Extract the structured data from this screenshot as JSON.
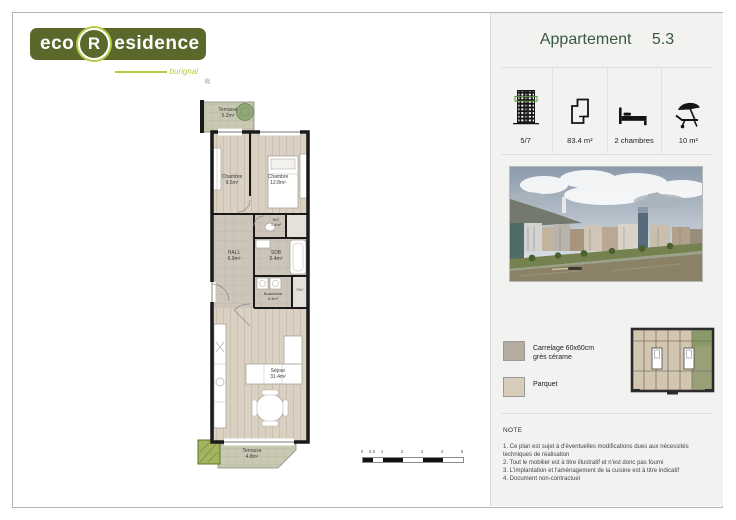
{
  "logo": {
    "eco": "eco",
    "r": "R",
    "esidence": "esidence",
    "subtitle": "burignal",
    "mark": "®",
    "colors": {
      "olive": "#5a682c",
      "light_green": "#b5cb47"
    }
  },
  "header": {
    "title": "Appartement",
    "number": "5.3",
    "color": "#3b5a41"
  },
  "stats": [
    {
      "icon": "building-icon",
      "label": "5/7"
    },
    {
      "icon": "floorplan-icon",
      "label": "83.4 m²"
    },
    {
      "icon": "bed-icon",
      "label": "2 chambres"
    },
    {
      "icon": "parasol-icon",
      "label": "10 m²"
    }
  ],
  "legend": {
    "items": [
      {
        "name": "carrelage",
        "line1": "Carrelage 60x60cm",
        "line2": "grès cérame",
        "color": "#b5ab9e"
      },
      {
        "name": "parquet",
        "line1": "Parquet",
        "line2": "",
        "color": "#d8cdbb"
      }
    ]
  },
  "note": {
    "title": "NOTE",
    "items": [
      "1. Ce plan est sujet à d'éventuelles modifications dues aux nécessités techniques de réalisation",
      "2. Tout le mobilier est à titre illustratif et n'est donc pas fourni",
      "3. L'implantation et l'aménagement de la cuisine est à titre indicatif",
      "4. Document non-contractuel"
    ]
  },
  "rooms": {
    "terrasse_top": {
      "name": "Terrasse",
      "area": "5.2m²"
    },
    "chambre1": {
      "name": "Chambre",
      "area": "9.5m²"
    },
    "chambre2": {
      "name": "Chambre",
      "area": "12.8m²"
    },
    "wc": {
      "name": "WC",
      "area": "1.4m²"
    },
    "hall": {
      "name": "HALL",
      "area": "6.9m²"
    },
    "sdb": {
      "name": "SDB",
      "area": "5.4m²"
    },
    "buanderie": {
      "name": "Buanderie",
      "area": "5.4m²"
    },
    "pac": {
      "name": "PAC"
    },
    "sejour": {
      "name": "Séjour",
      "area": "31.4m²"
    },
    "terrasse_bottom": {
      "name": "Terrasse",
      "area": "4.8m²"
    }
  },
  "scalebar": {
    "labels": [
      "0",
      "0.5",
      "1",
      "2",
      "3",
      "4",
      "5"
    ]
  }
}
